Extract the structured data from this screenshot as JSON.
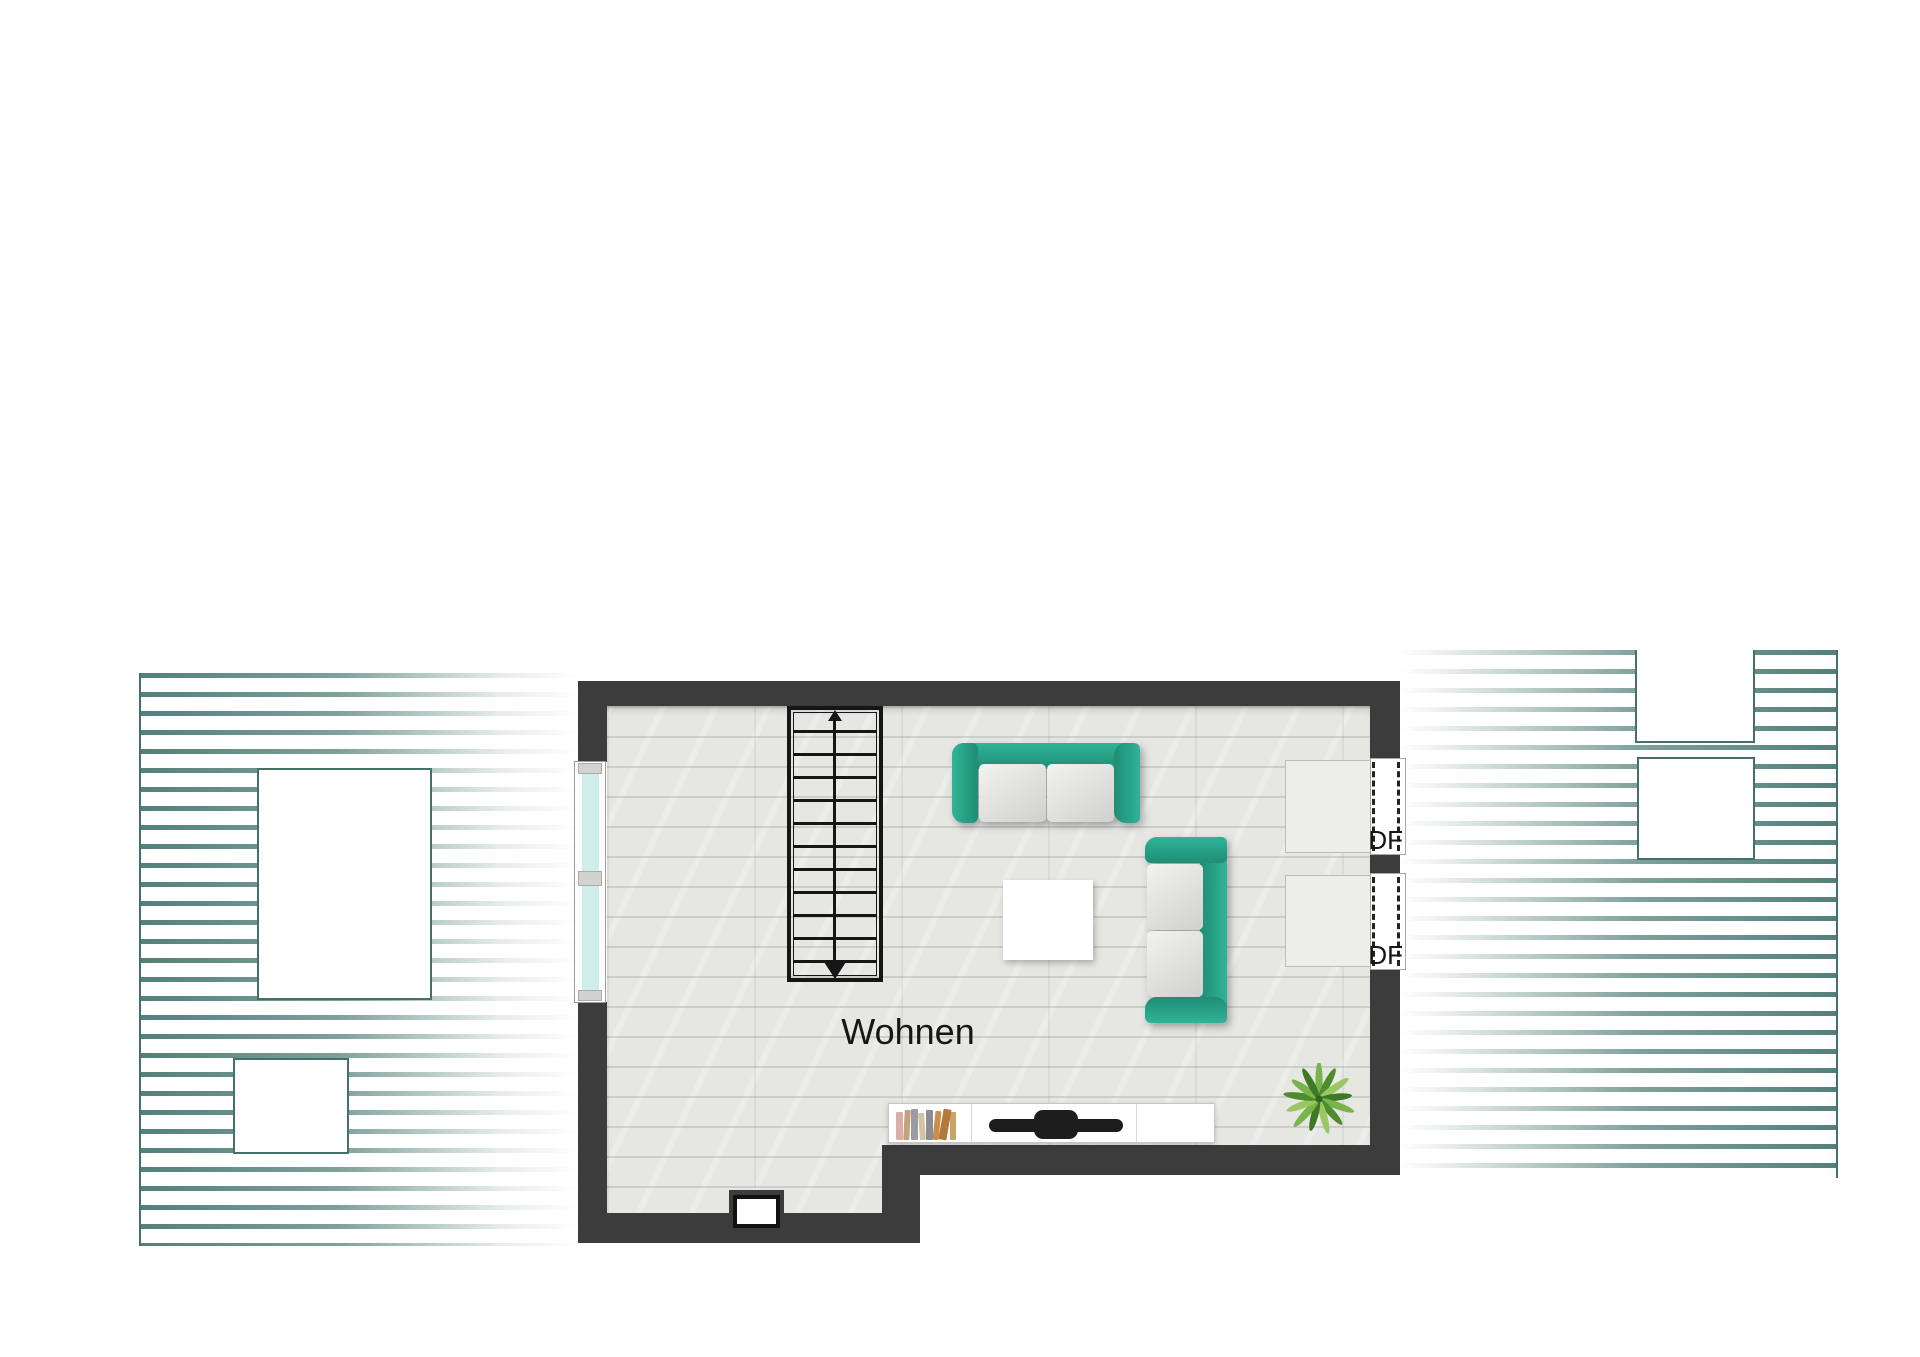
{
  "plan": {
    "room": {
      "label": "Wohnen"
    },
    "roof_windows": [
      {
        "label": "DF"
      },
      {
        "label": "DF"
      }
    ],
    "furniture": {
      "sofa_top": "two-seater-sofa",
      "sofa_side": "two-seater-sofa",
      "coffee_table": "coffee-table",
      "sideboard_sections": [
        "books",
        "tv",
        "empty"
      ],
      "plant": "potted-plant",
      "staircase": {
        "steps": 12,
        "direction": "down"
      }
    },
    "colors": {
      "wall": "#3c3c3c",
      "floor": "#e6e6e3",
      "sofa": "#29a78d",
      "sofa-dark": "#1b8a71",
      "cushion": "#ececea",
      "hatch": "#54807a",
      "hatch-border": "#44706a",
      "glass": "#cdeeea",
      "stair": "#161616",
      "text": "#161616",
      "tv": "#1d1d1d"
    }
  }
}
